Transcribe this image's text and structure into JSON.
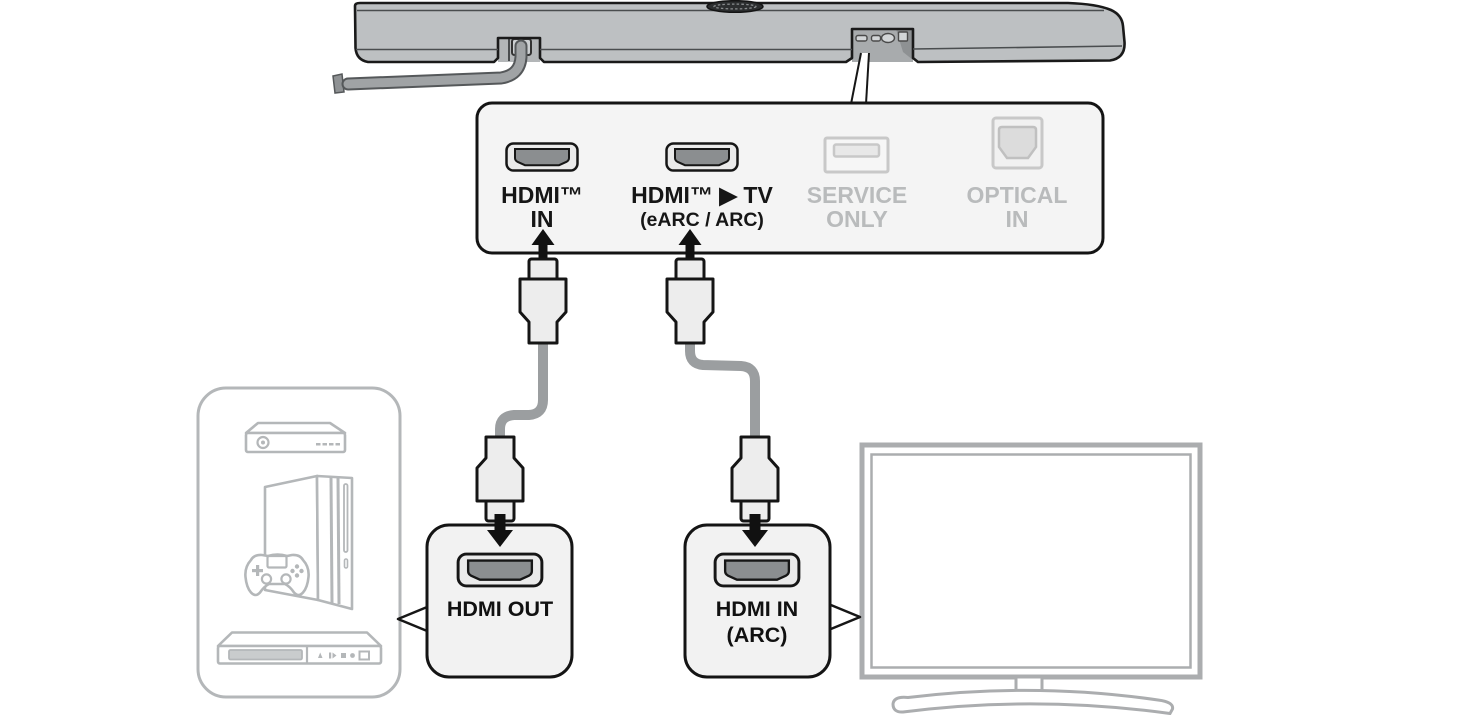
{
  "rear_panel": {
    "ports": [
      {
        "icon": "hdmi-port-icon",
        "line1": "HDMI™",
        "line2": "IN",
        "state": "active"
      },
      {
        "icon": "hdmi-port-icon",
        "line1": "HDMI™ ▶ TV",
        "line2": "(eARC / ARC)",
        "state": "active"
      },
      {
        "icon": "usb-port-icon",
        "line1": "SERVICE",
        "line2": "ONLY",
        "state": "inactive"
      },
      {
        "icon": "optical-port-icon",
        "line1": "OPTICAL",
        "line2": "IN",
        "state": "inactive"
      }
    ]
  },
  "callouts": {
    "hdmi_out": {
      "label": "HDMI OUT"
    },
    "hdmi_in_arc": {
      "line1": "HDMI IN",
      "line2": "(ARC)"
    }
  },
  "colors": {
    "outline": "#161616",
    "panel_fill": "#f4f4f4",
    "soundbar_gray": "#bdc0c2",
    "port_dark_gray": "#8b8e90",
    "inactive_gray": "#b9bbbc",
    "cable_gray": "#9b9ea0",
    "device_line_gray": "#b4b7b9",
    "tv_line_gray": "#abadaf"
  }
}
